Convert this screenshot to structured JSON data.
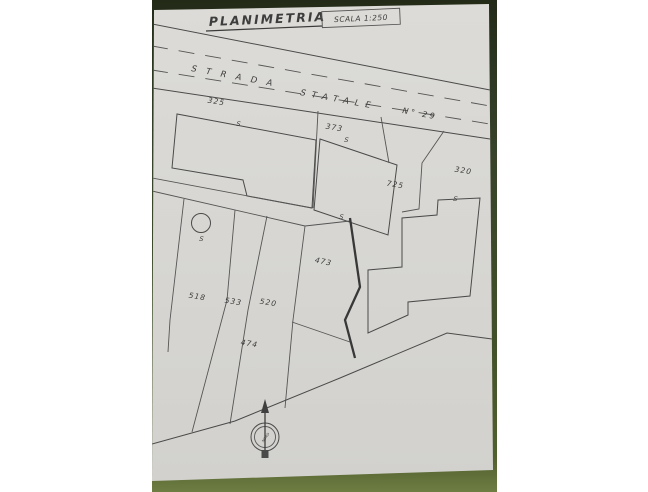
{
  "title": {
    "text": "PLANIMETRIA",
    "scale": "SCALA 1:250"
  },
  "road": {
    "word1": "STRADA",
    "word2": "STATALE",
    "word3": "N° 29"
  },
  "parcels": [
    {
      "label": "325"
    },
    {
      "label": "373"
    },
    {
      "label": "320"
    },
    {
      "label": "725"
    },
    {
      "label": "473"
    },
    {
      "label": "518"
    },
    {
      "label": "533"
    },
    {
      "label": "520"
    },
    {
      "label": "474"
    }
  ],
  "annotations": {
    "s_marks": [
      "S",
      "S",
      "S",
      "S",
      "S"
    ]
  },
  "compass": {
    "label": "NORD"
  },
  "colors": {
    "paper": "#d8d7d3",
    "ink": "#4a4a4a",
    "green_background": "#42512a"
  }
}
